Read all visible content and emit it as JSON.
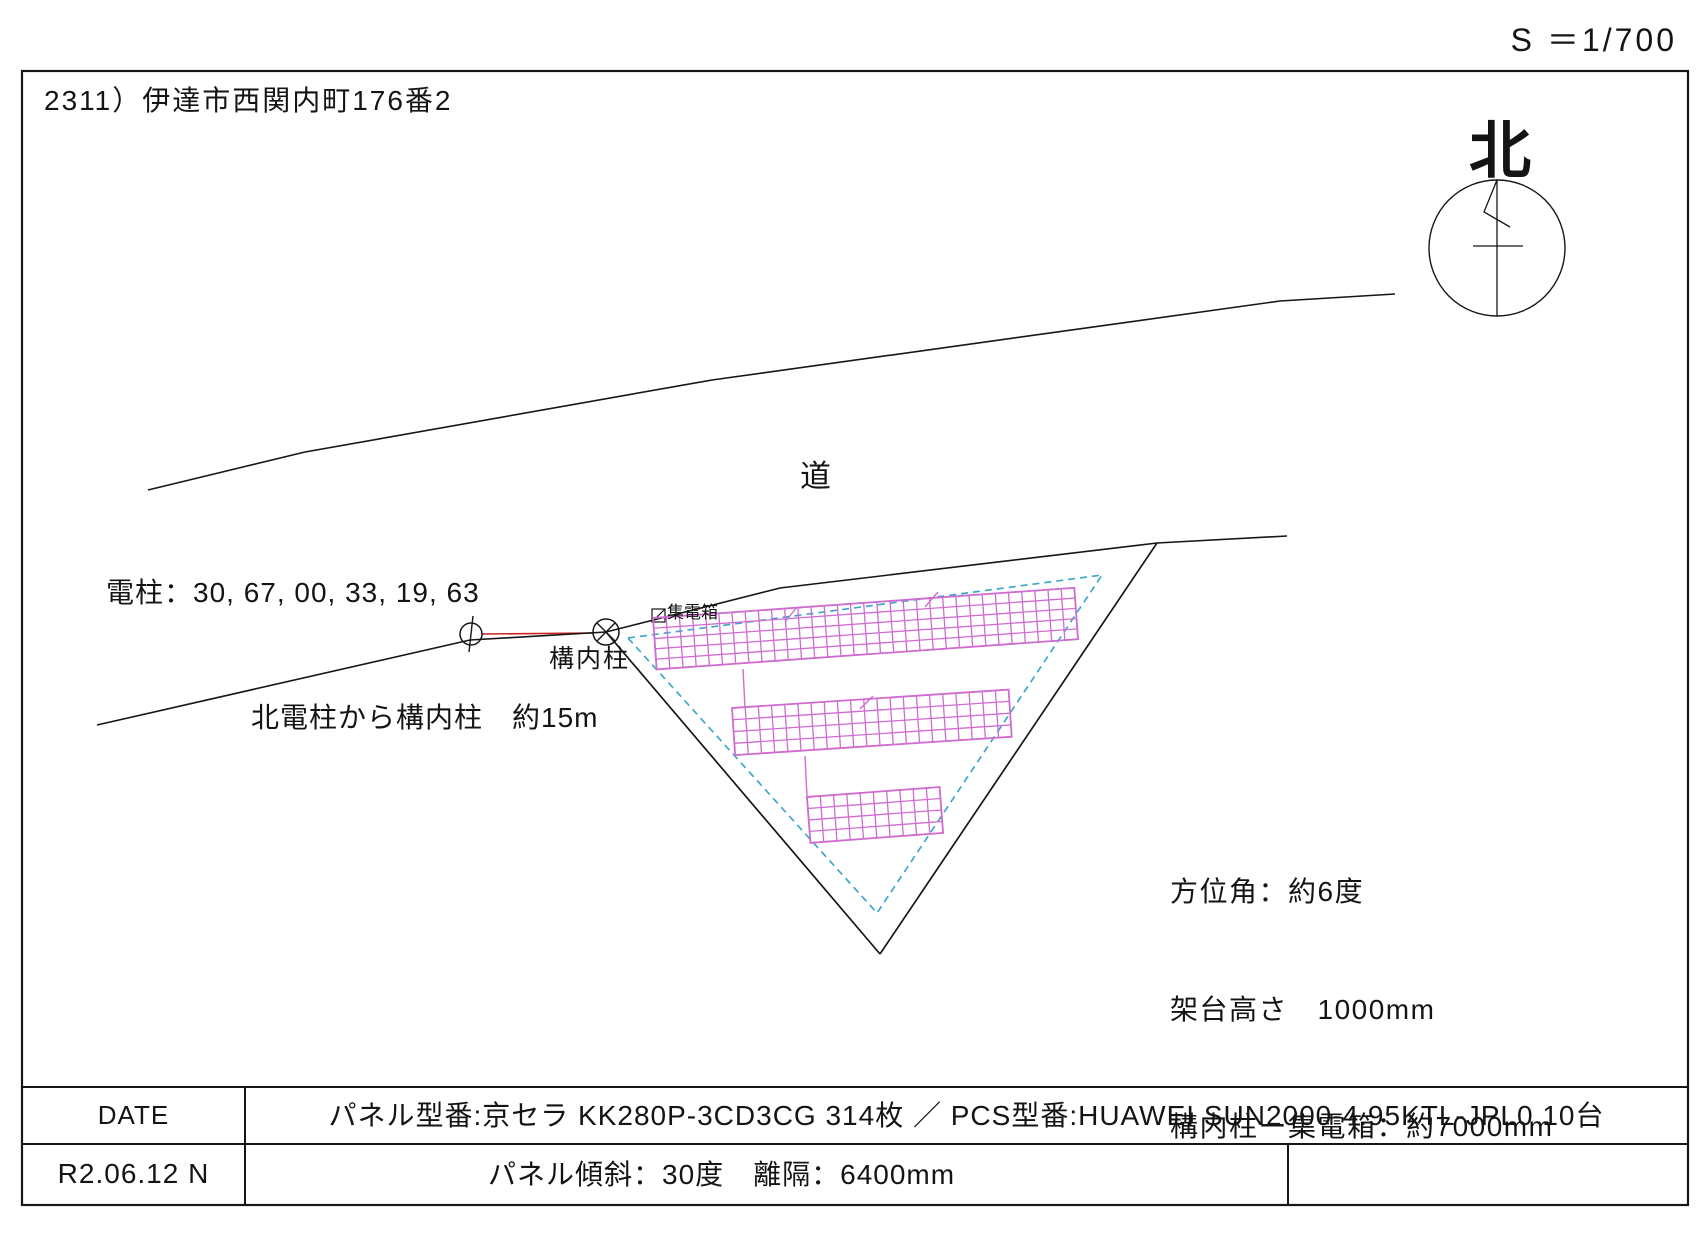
{
  "scale_label": "S ＝1/700",
  "title": "2311）伊達市西関内町176番2",
  "north_label": "北",
  "road_label": "道",
  "pole_label": "電柱：30, 67, 00, 33, 19, 63",
  "konai_label": "構内柱",
  "distance_label": "北電柱から構内柱　約15m",
  "collector_label": "集電箱",
  "notes": {
    "azimuth": "方位角：約6度",
    "mount_height": "架台高さ　1000mm",
    "collector_distance": "構内柱ー集電箱：約7000mm"
  },
  "table": {
    "date_label": "DATE",
    "date_value": "R2.06.12 N",
    "panel_spec": "パネル型番:京セラ KK280P-3CD3CG 314枚 ／ PCS型番:HUAWEI SUN2000-4.95KTL-JPL0 10台",
    "tilt_spec": "パネル傾斜：30度　離隔：6400mm"
  },
  "colors": {
    "line": "#161616",
    "red": "#cc2222",
    "panel": "#cf6ccf",
    "setback": "#3fa8c8"
  },
  "geometry": {
    "width": 1707,
    "height": 1238,
    "border": {
      "name": "drawing-border",
      "x": 22,
      "y": 71,
      "w": 1666,
      "h": 1134,
      "w2": 2.2
    },
    "lines": [
      {
        "name": "table-top-line",
        "x1": 22,
        "y1": 1087,
        "x2": 1688,
        "y2": 1087,
        "c": "line",
        "w": 2
      },
      {
        "name": "table-row-divider",
        "x1": 22,
        "y1": 1144,
        "x2": 1688,
        "y2": 1144,
        "c": "line",
        "w": 2
      },
      {
        "name": "table-col-divider-1",
        "x1": 245,
        "y1": 1087,
        "x2": 245,
        "y2": 1205,
        "c": "line",
        "w": 2
      },
      {
        "name": "table-col-divider-2",
        "x1": 1288,
        "y1": 1144,
        "x2": 1288,
        "y2": 1205,
        "c": "line",
        "w": 2
      },
      {
        "name": "site-boundary-left",
        "x1": 606,
        "y1": 632,
        "x2": 880,
        "y2": 954,
        "c": "line",
        "w": 1.7
      },
      {
        "name": "site-boundary-right",
        "x1": 1157,
        "y1": 543,
        "x2": 880,
        "y2": 954,
        "c": "line",
        "w": 1.7
      },
      {
        "name": "north-needle-line",
        "x1": 1497,
        "y1": 180,
        "x2": 1497,
        "y2": 316,
        "c": "line",
        "w": 1.3
      },
      {
        "name": "north-cross-line",
        "x1": 1473,
        "y1": 246,
        "x2": 1523,
        "y2": 246,
        "c": "line",
        "w": 1.3
      },
      {
        "name": "pole-mast-line",
        "x1": 473,
        "y1": 616,
        "x2": 469,
        "y2": 652,
        "c": "line",
        "w": 1.4
      },
      {
        "name": "konai-cross-line-1",
        "x1": 597,
        "y1": 623,
        "x2": 615,
        "y2": 641,
        "c": "line",
        "w": 1.4
      },
      {
        "name": "konai-cross-line-2",
        "x1": 597,
        "y1": 641,
        "x2": 615,
        "y2": 623,
        "c": "line",
        "w": 1.4
      },
      {
        "name": "collector-box-diagonal",
        "x1": 652,
        "y1": 622,
        "x2": 665,
        "y2": 609,
        "c": "line",
        "w": 1.2
      },
      {
        "name": "pole-connection-line",
        "x1": 482,
        "y1": 634,
        "x2": 593,
        "y2": 633,
        "c": "red",
        "w": 1.6
      },
      {
        "name": "array-connector-1",
        "x1": 743,
        "y1": 669,
        "x2": 745,
        "y2": 708,
        "c": "panel",
        "w": 1.4
      },
      {
        "name": "array-connector-2",
        "x1": 805,
        "y1": 756,
        "x2": 807,
        "y2": 797,
        "c": "panel",
        "w": 1.4
      },
      {
        "name": "string-mark-1",
        "x1": 785,
        "y1": 622,
        "x2": 797,
        "y2": 607,
        "c": "panel",
        "w": 1.4
      },
      {
        "name": "string-mark-2",
        "x1": 925,
        "y1": 607,
        "x2": 938,
        "y2": 592,
        "c": "panel",
        "w": 1.4
      },
      {
        "name": "string-mark-3",
        "x1": 860,
        "y1": 709,
        "x2": 873,
        "y2": 696,
        "c": "panel",
        "w": 1.4
      }
    ],
    "polylines": [
      {
        "name": "road-upper-edge",
        "points": "148,490 305,452 712,380 1280,301 1395,294",
        "c": "line",
        "w": 1.6
      },
      {
        "name": "road-lower-edge",
        "points": "97,725 470,640 606,632 780,588 1157,543 1287,536",
        "c": "line",
        "w": 1.6
      },
      {
        "name": "setback-boundary",
        "points": "628,638 1102,575 877,913 628,638",
        "c": "setback",
        "w": 1.7,
        "dash": "7,5"
      },
      {
        "name": "north-pennant",
        "points": "1497,180 1484,212 1510,227",
        "c": "line",
        "w": 1.3
      }
    ],
    "circles": [
      {
        "name": "north-circle",
        "cx": 1497,
        "cy": 248,
        "r": 68,
        "w": 1.4
      },
      {
        "name": "pole-circle",
        "cx": 471,
        "cy": 634,
        "r": 11,
        "w": 1.5
      },
      {
        "name": "konai-circle",
        "cx": 606,
        "cy": 632,
        "r": 13,
        "w": 1.5
      }
    ],
    "rects": [
      {
        "name": "collector-box",
        "x": 652,
        "y": 609,
        "w2": 13,
        "h2": 13,
        "w": 1.2
      }
    ],
    "panel_arrays": [
      {
        "name": "panel-array-north",
        "x": 653,
        "y": 618,
        "cols": 32,
        "rows": 5,
        "cw": 13.2,
        "ch": 10.3,
        "angle": -4.1
      },
      {
        "name": "panel-array-middle",
        "x": 732,
        "y": 708,
        "cols": 21,
        "rows": 4,
        "cw": 13.2,
        "ch": 11.8,
        "angle": -3.8
      },
      {
        "name": "panel-array-south",
        "x": 807,
        "y": 797,
        "cols": 10,
        "rows": 4,
        "cw": 13.3,
        "ch": 11.5,
        "angle": -4.3
      }
    ]
  }
}
